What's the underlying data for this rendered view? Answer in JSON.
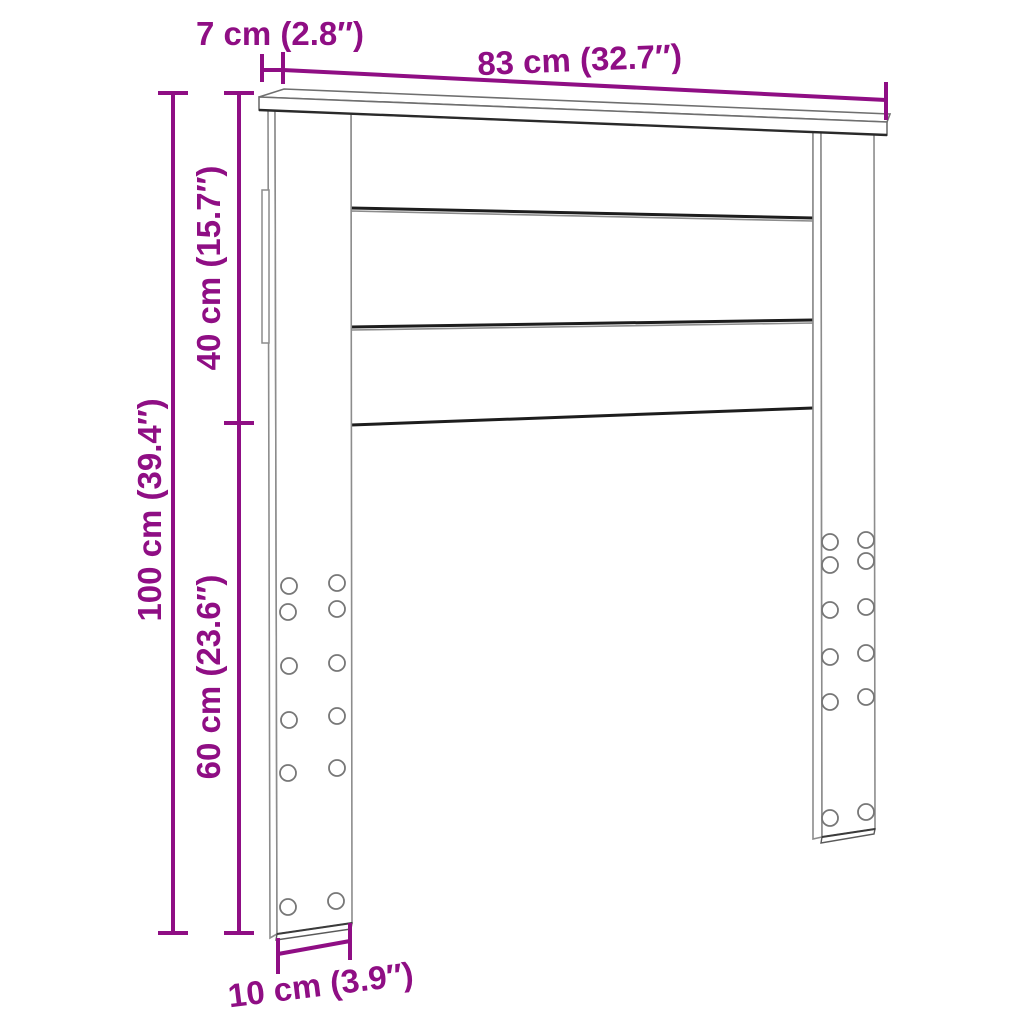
{
  "figure": {
    "type": "furniture-dimension-diagram",
    "subject": "bed headboard with two legs, top cap board and three horizontal panels",
    "accent_color": "#8F0E84",
    "outline_color": "#8f8f8f",
    "edge_color": "#1d1d1d",
    "background": "#ffffff"
  },
  "dimensions": {
    "width": {
      "cm": "83",
      "in": "32.7",
      "label": "83 cm (32.7″)"
    },
    "depth": {
      "cm": "7",
      "in": "2.8",
      "label": "7 cm (2.8″)"
    },
    "total_height": {
      "cm": "100",
      "in": "39.4",
      "label": "100 cm (39.4″)"
    },
    "panel_height": {
      "cm": "40",
      "in": "15.7",
      "label": "40 cm (15.7″)"
    },
    "leg_height": {
      "cm": "60",
      "in": "23.6",
      "label": "60 cm (23.6″)"
    },
    "leg_depth": {
      "cm": "10",
      "in": "3.9",
      "label": "10 cm (3.9″)"
    }
  },
  "holes": {
    "left_leg_visible_count": 12,
    "right_leg_visible_count": 12
  }
}
